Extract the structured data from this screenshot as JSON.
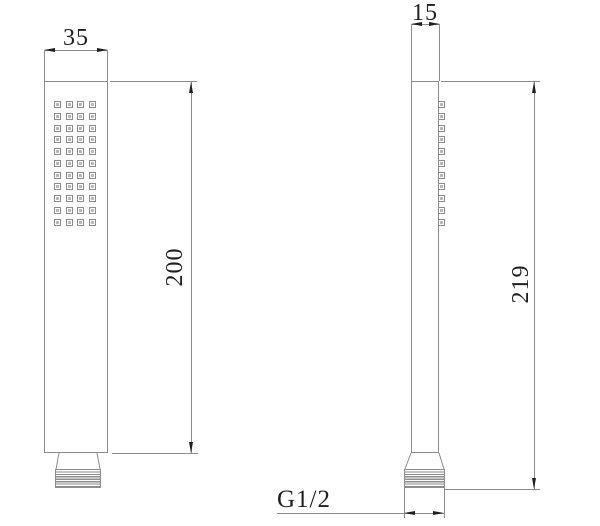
{
  "views": {
    "front": {
      "width_dim": "35",
      "height_dim": "200",
      "nozzle_rows": 11,
      "nozzle_cols": 4
    },
    "side": {
      "width_dim": "15",
      "height_dim": "219",
      "thread_dim": "G1/2",
      "nozzle_rows": 11,
      "nozzle_cols": 1
    }
  },
  "colors": {
    "line": "#8c8c8c",
    "ink": "#1f1f1f",
    "background": "#ffffff"
  }
}
